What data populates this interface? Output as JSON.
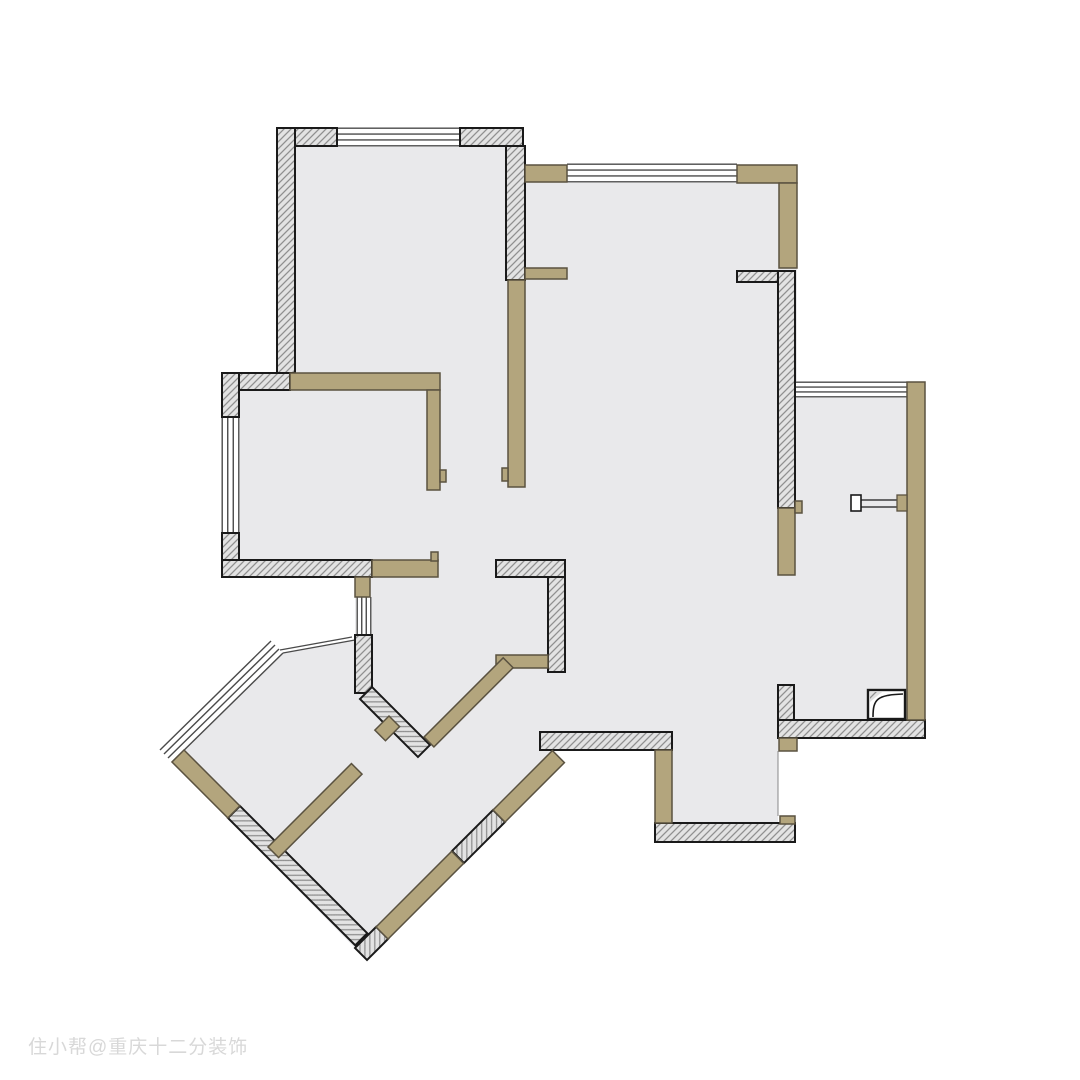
{
  "watermark": {
    "text": "住小帮@重庆十二分装饰"
  },
  "colors": {
    "background": "#ffffff",
    "floor": "#e9e9eb",
    "hatch_base": "#e3e3e3",
    "hatch_line": "#8f8f8f",
    "wall_outline": "#1a1a1a",
    "tan_fill": "#b3a57d",
    "tan_outline": "#5a5240",
    "window_line": "#4a4a4a",
    "void_edge": "#888888",
    "watermark_color": "#d8d8d8"
  },
  "plan": {
    "floor_polygon": "277,128 523,128 523,165 797,165 797,385 925,385 925,738 778,738 778,842 655,842 655,750 552,750 355,948 172,762 283,653 355,640 355,577 222,577 222,373 277,373",
    "hatched_rects": [
      [
        277,
        128,
        60,
        18
      ],
      [
        277,
        128,
        18,
        245
      ],
      [
        460,
        128,
        63,
        18
      ],
      [
        506,
        146,
        19,
        134
      ],
      [
        222,
        373,
        68,
        17
      ],
      [
        222,
        373,
        17,
        44
      ],
      [
        222,
        533,
        17,
        44
      ],
      [
        222,
        560,
        150,
        17
      ],
      [
        496,
        560,
        69,
        17
      ],
      [
        548,
        577,
        17,
        95
      ],
      [
        737,
        271,
        41,
        11
      ],
      [
        778,
        271,
        17,
        237
      ],
      [
        778,
        720,
        147,
        18
      ],
      [
        655,
        823,
        140,
        19
      ],
      [
        540,
        732,
        132,
        18
      ],
      [
        778,
        685,
        16,
        35
      ],
      [
        355,
        635,
        17,
        58
      ]
    ],
    "hatched_rot": [
      [
        372,
        687,
        45,
        82,
        17
      ],
      [
        240,
        806,
        45,
        180,
        17
      ],
      [
        355,
        948,
        -45,
        30,
        17
      ],
      [
        452,
        851,
        -45,
        58,
        17
      ]
    ],
    "tan_rects": [
      [
        290,
        373,
        150,
        17
      ],
      [
        427,
        390,
        13,
        100
      ],
      [
        440,
        470,
        6,
        12
      ],
      [
        508,
        280,
        17,
        207
      ],
      [
        502,
        468,
        6,
        13
      ],
      [
        525,
        165,
        42,
        17
      ],
      [
        525,
        268,
        42,
        11
      ],
      [
        737,
        165,
        60,
        18
      ],
      [
        779,
        183,
        18,
        85
      ],
      [
        907,
        382,
        18,
        338
      ],
      [
        778,
        508,
        17,
        67
      ],
      [
        795,
        501,
        7,
        12
      ],
      [
        779,
        738,
        18,
        13
      ],
      [
        655,
        750,
        17,
        73
      ],
      [
        780,
        816,
        15,
        8
      ],
      [
        372,
        560,
        66,
        17
      ],
      [
        431,
        552,
        7,
        9
      ],
      [
        355,
        577,
        15,
        20
      ],
      [
        496,
        655,
        52,
        13
      ]
    ],
    "tan_rot": [
      [
        184,
        750,
        45,
        79,
        17
      ],
      [
        376,
        927,
        -45,
        107,
        17
      ],
      [
        493,
        810,
        -45,
        84,
        17
      ],
      [
        424,
        737,
        -45,
        112,
        14
      ],
      [
        268,
        847,
        -45,
        118,
        15
      ],
      [
        389,
        716,
        45,
        15,
        20
      ]
    ],
    "windows": [
      [
        337,
        127,
        123,
        20,
        "h"
      ],
      [
        567,
        163,
        170,
        20,
        "h"
      ],
      [
        795,
        381,
        112,
        17,
        "h"
      ],
      [
        221,
        417,
        19,
        116,
        "v"
      ],
      [
        356,
        597,
        16,
        38,
        "v"
      ]
    ],
    "diag_window_lines": [
      [
        172,
        762,
        283,
        653
      ],
      [
        168,
        758,
        279,
        649
      ],
      [
        164,
        754,
        275,
        645
      ],
      [
        160,
        750,
        271,
        641
      ]
    ],
    "sill_lines": [
      [
        283,
        653,
        355,
        640
      ],
      [
        280,
        650,
        352,
        637
      ]
    ],
    "void_overlay": [
      778,
      751,
      17,
      65
    ],
    "void_edge_line": [
      778,
      751,
      778,
      816
    ],
    "fixture_bar": {
      "lines": [
        [
          861,
          500,
          897,
          500
        ],
        [
          861,
          507,
          897,
          507
        ]
      ],
      "end_box": [
        851,
        495,
        10,
        16
      ],
      "attach": [
        897,
        495,
        10,
        16
      ]
    },
    "flue_box": [
      868,
      690,
      37,
      29
    ]
  }
}
